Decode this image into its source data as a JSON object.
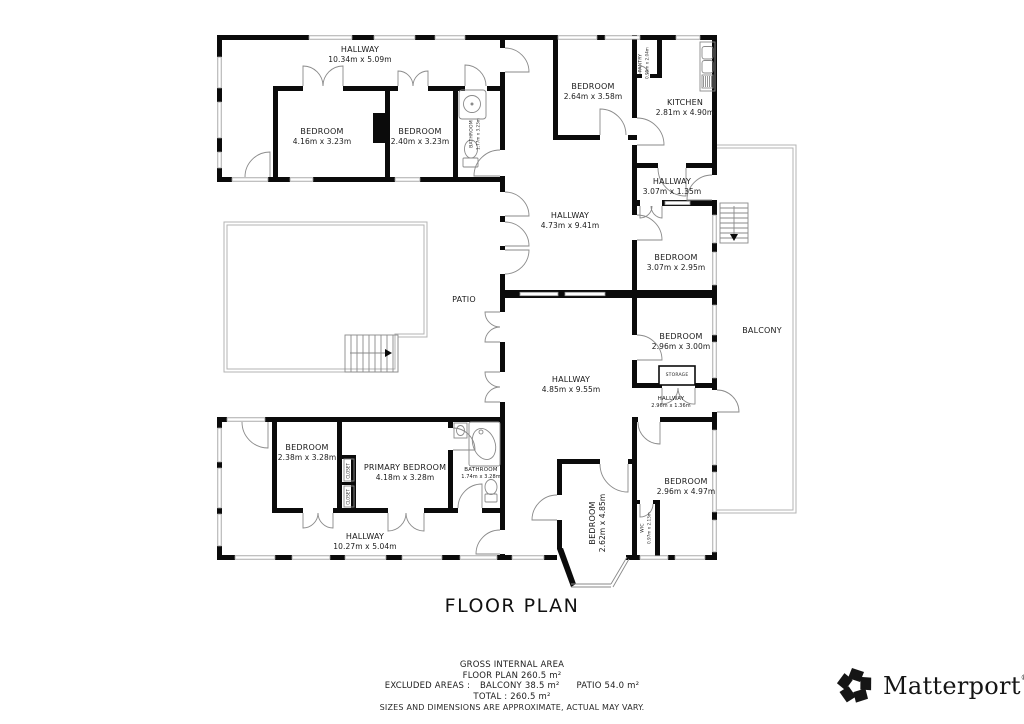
{
  "title": "FLOOR PLAN",
  "footer": {
    "gross_internal_area_label": "GROSS INTERNAL AREA",
    "floor_plan_area": "FLOOR PLAN 260.5 m²",
    "excluded_label": "EXCLUDED AREAS :",
    "excluded_balcony": "BALCONY 38.5 m²",
    "excluded_patio": "PATIO 54.0 m²",
    "total": "TOTAL : 260.5 m²",
    "disclaimer": "SIZES AND DIMENSIONS ARE APPROXIMATE, ACTUAL MAY VARY."
  },
  "branding": {
    "logo_text": "Matterport",
    "registered_mark": "®",
    "logo_icon": "matterport-pinwheel-icon"
  },
  "colors": {
    "wall": "#0b0b0b",
    "thin_line": "#8a8a8a",
    "outline": "#b3b3b3",
    "text": "#1a1a1a",
    "background": "#ffffff"
  },
  "rooms": {
    "hallway_top_left": {
      "name": "HALLWAY",
      "dims": "10.34m x 5.09m"
    },
    "bedroom_top_left_1": {
      "name": "BEDROOM",
      "dims": "4.16m x 3.23m"
    },
    "bedroom_top_left_2": {
      "name": "BEDROOM",
      "dims": "2.40m x 3.23m"
    },
    "bathroom_top_left": {
      "name": "BATHROOM",
      "dims": "1.77m x 3.23m"
    },
    "bedroom_top_right": {
      "name": "BEDROOM",
      "dims": "2.64m x 3.58m"
    },
    "pantry": {
      "name": "PANTRY",
      "dims": "0.95m x 2.04m"
    },
    "kitchen": {
      "name": "KITCHEN",
      "dims": "2.81m x 4.90m"
    },
    "hallway_central_upper": {
      "name": "HALLWAY",
      "dims": "4.73m x 9.41m"
    },
    "hallway_top_right": {
      "name": "HALLWAY",
      "dims": "3.07m x 1.35m"
    },
    "bedroom_right_1": {
      "name": "BEDROOM",
      "dims": "3.07m x 2.95m"
    },
    "bedroom_right_2": {
      "name": "BEDROOM",
      "dims": "2.96m x 3.00m"
    },
    "storage": {
      "name": "STORAGE"
    },
    "hallway_right": {
      "name": "HALLWAY",
      "dims": "2.96m x 1.36m"
    },
    "balcony": {
      "name": "BALCONY"
    },
    "patio": {
      "name": "PATIO"
    },
    "hallway_central_lower": {
      "name": "HALLWAY",
      "dims": "4.85m x 9.55m"
    },
    "bedroom_right_3": {
      "name": "BEDROOM",
      "dims": "2.96m x 4.97m"
    },
    "wic": {
      "name": "WIC",
      "dims": "0.97m x 2.13m"
    },
    "bedroom_bay": {
      "name": "BEDROOM",
      "dims": "2.62m x 4.85m"
    },
    "bedroom_bottom_left": {
      "name": "BEDROOM",
      "dims": "2.38m x 3.28m"
    },
    "closet_1": {
      "name": "CLOSET"
    },
    "closet_2": {
      "name": "CLOSET"
    },
    "primary_bedroom": {
      "name": "PRIMARY BEDROOM",
      "dims": "4.18m x 3.28m"
    },
    "bathroom_bottom_left": {
      "name": "BATHROOM",
      "dims": "1.74m x 3.28m"
    },
    "hallway_bottom_left": {
      "name": "HALLWAY",
      "dims": "10.27m x 5.04m"
    }
  }
}
